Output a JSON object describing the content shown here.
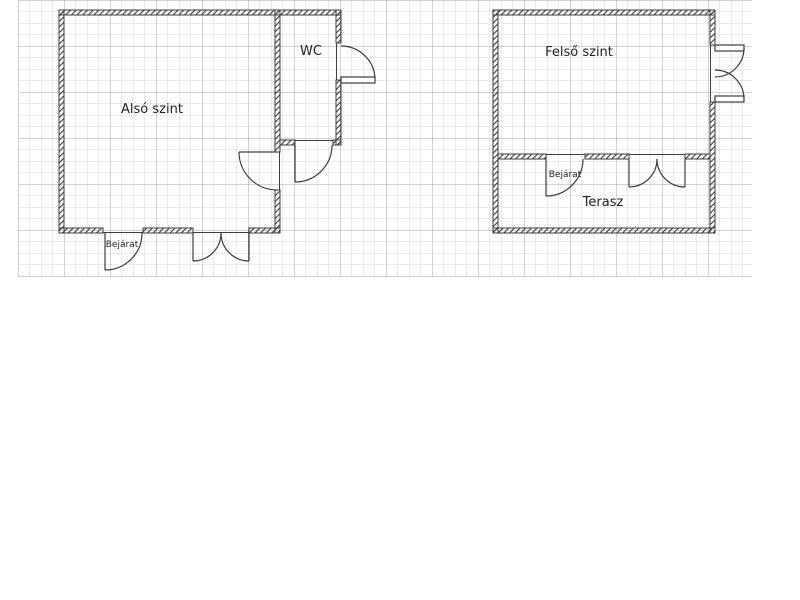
{
  "diagram": {
    "type": "floor-plan",
    "description": "Two-level floor plan drawn on graph paper",
    "labels": {
      "also_szint": "Alsó szint",
      "wc": "WC",
      "bejarat_lower": "Bejárat",
      "felso_szint": "Felső szint",
      "terasz": "Terasz",
      "bejarat_upper": "Bejárat"
    },
    "units": [
      {
        "name": "lower-level",
        "rooms": [
          "Alsó szint",
          "WC"
        ],
        "entrance": "Bejárat",
        "doors": 5
      },
      {
        "name": "upper-level",
        "rooms": [
          "Felső szint",
          "Terasz"
        ],
        "entrance": "Bejárat",
        "doors": 3
      }
    ],
    "grid": {
      "fine_cell_px": 11.5,
      "major_cell_px": 46
    },
    "colors": {
      "background": "#ffffff",
      "grid_fine": "#d9d9d9",
      "grid_major": "#a6a6a6",
      "wall_line": "#3d3d3d",
      "text": "#222222"
    }
  }
}
